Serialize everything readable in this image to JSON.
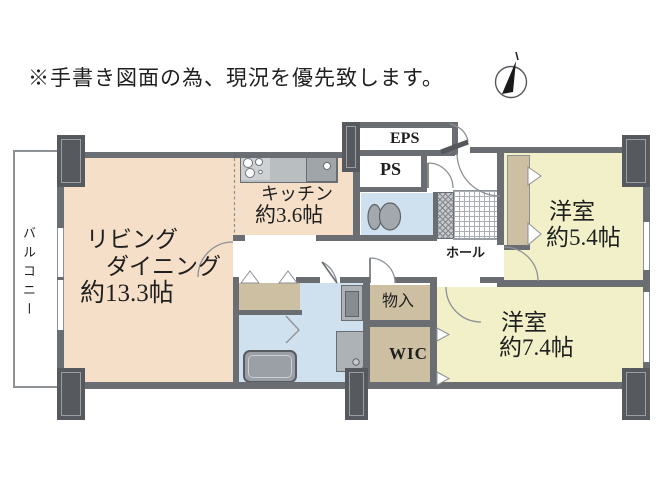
{
  "disclaimer": "※手書き図面の為、現況を優先致します。",
  "palette": {
    "wall": "#6a6e72",
    "pillar": "#565a5e",
    "living": "#f6dfc8",
    "bedroom": "#f1f0c9",
    "closet": "#cdbfa2",
    "wet": "#cfe0ee",
    "counter": "#b9bec1",
    "line": "#8d9196"
  },
  "rooms": {
    "balcony": {
      "label": "バルコニー"
    },
    "living": {
      "line1": "リビング",
      "line2": "ダイニング",
      "size": "約13.3帖"
    },
    "kitchen": {
      "label": "キッチン",
      "size": "約3.6帖"
    },
    "eps": {
      "label": "EPS"
    },
    "ps": {
      "label": "PS"
    },
    "hall": {
      "label": "ホール"
    },
    "storage": {
      "label": "物入"
    },
    "wic": {
      "label": "WIC"
    },
    "bedroom_54": {
      "label": "洋室",
      "size": "約5.4帖"
    },
    "bedroom_74": {
      "label": "洋室",
      "size": "約7.4帖"
    }
  }
}
